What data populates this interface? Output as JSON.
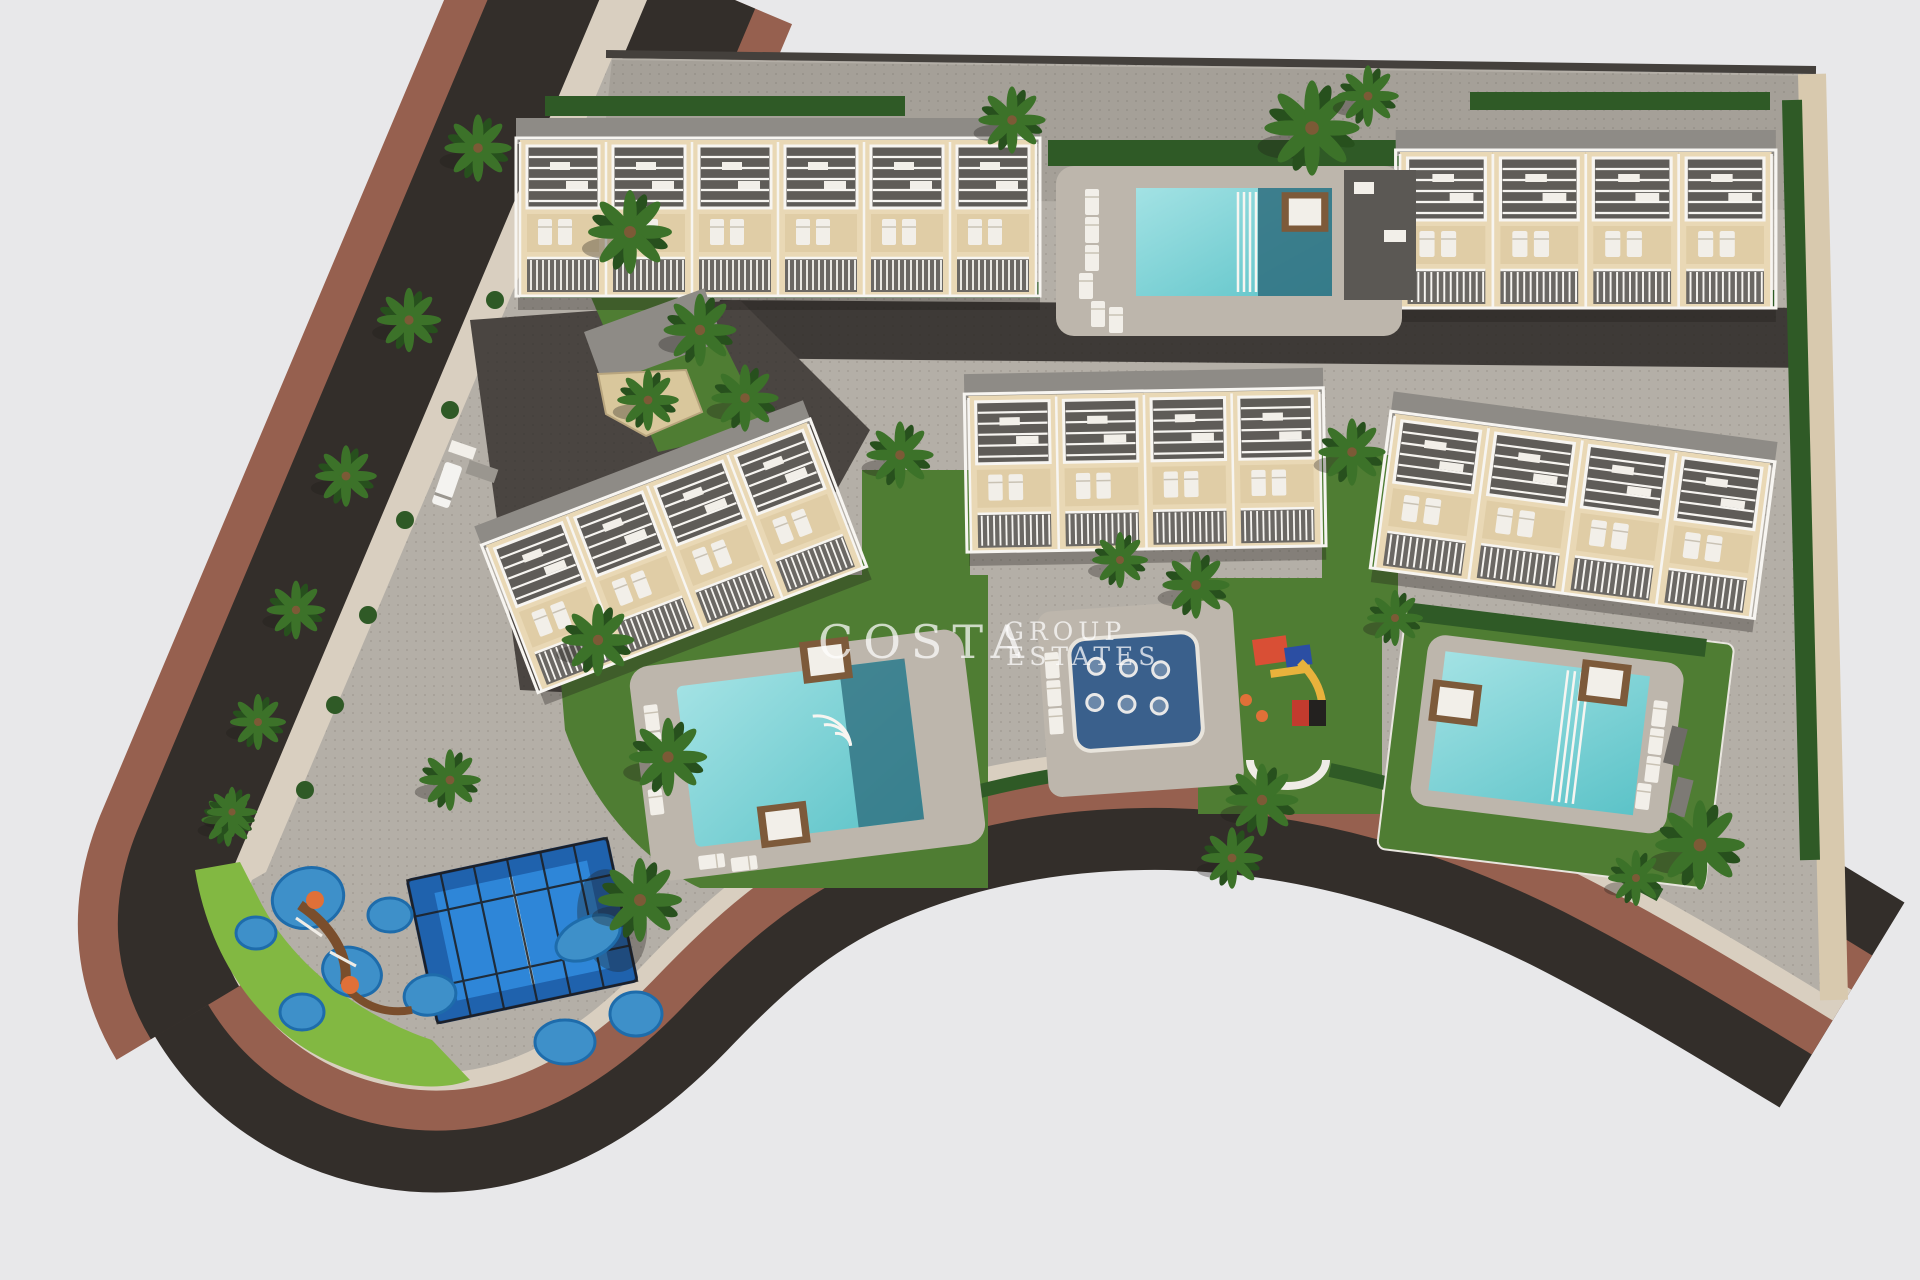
{
  "meta": {
    "type": "aerial-3d-site-plan-render",
    "description": "Bird's-eye 3D render of a residential development: five townhouse blocks, four pool areas, padel court, playgrounds, palm trees and a perimeter road"
  },
  "watermark": {
    "brand_top": "COSTA",
    "brand_mid": "GROUP",
    "brand_bottom": "ESTATES",
    "color": "#ffffff"
  },
  "palette": {
    "background": "#e8e8ea",
    "road_asphalt": "#332e2a",
    "sidewalk_red": "#96604f",
    "curb_beige": "#d9cfc0",
    "paving_gray": "#b4afa7",
    "walkway_gray": "#a5a098",
    "drive_dark": "#3e3a37",
    "paving_dark": "#4a4541",
    "deck_gray": "#bdb6ac",
    "grass_green": "#4f7d33",
    "grass_lime": "#82b842",
    "hedge_green": "#2f5a26",
    "palm_green": "#3c7229",
    "palm_dark": "#27501d",
    "building_wall": "#e9d8b5",
    "building_patio": "#e0cda6",
    "roof_gray": "#8e8b86",
    "terrace_dark": "#5f5c58",
    "balcony_dark": "#6b6864",
    "trim_white": "#f7f5f1",
    "lounger_white": "#f2efe9",
    "daybed_brown": "#7d5a3a",
    "pool_water": "#7fd2d6",
    "pool_deep": "#2f6f7f",
    "splash_pad": "#3a608c",
    "splash_blue": "#3e90c9",
    "splash_blue_dark": "#1e6cab",
    "court_blue": "#2e86d8",
    "court_border": "#1f62ad",
    "cage_dark": "#1d1d1f",
    "boundary_wall": "#d8c9ae"
  },
  "scene": {
    "buildings": [
      {
        "id": "top-left",
        "units": 6,
        "rotation_deg": 0
      },
      {
        "id": "top-right",
        "units": 4,
        "rotation_deg": 0
      },
      {
        "id": "mid-left",
        "units": 4,
        "rotation_deg": -21
      },
      {
        "id": "mid-center",
        "units": 4,
        "rotation_deg": -1
      },
      {
        "id": "mid-right",
        "units": 4,
        "rotation_deg": 7.5
      }
    ],
    "amenities": [
      "north-pool",
      "southwest-pool",
      "kids-splash-pad",
      "central-playground",
      "padel-court",
      "splash-play-area",
      "sun-loungers",
      "daybeds"
    ],
    "vegetation": {
      "palm_count": 27
    },
    "vehicles": [
      "white-van",
      "gray-car",
      "gray-car"
    ]
  }
}
